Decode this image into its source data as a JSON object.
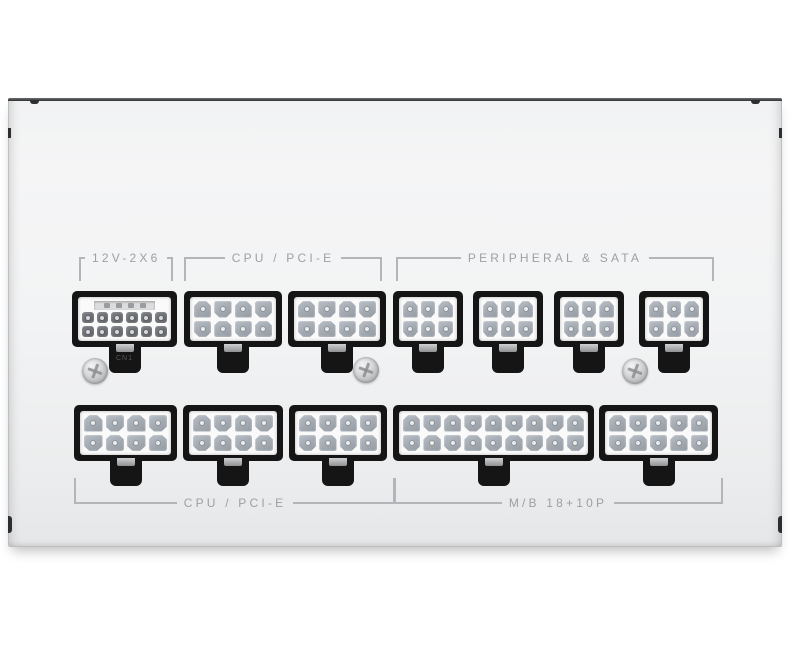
{
  "scene": {
    "type": "product-photo",
    "subject": "White fully modular power supply — modular cable connector panel, top-down view",
    "background_color": "#ffffff"
  },
  "labels": {
    "top": [
      {
        "text": "12V-2X6"
      },
      {
        "text": "CPU / PCI-E"
      },
      {
        "text": "PERIPHERAL & SATA"
      }
    ],
    "bottom": [
      {
        "text": "CPU / PCI-E"
      },
      {
        "text": "M/B 18+10P"
      }
    ]
  },
  "connectors": {
    "top_row": [
      {
        "name": "12v-2x6",
        "type": "12+4-pin 12V-2X6",
        "cols": 6,
        "rows": 2,
        "sense_pins": 4,
        "pin_style": "dark",
        "tab_label": "CN1"
      },
      {
        "name": "cpu-pcie-top-1",
        "type": "8-pin",
        "cols": 4,
        "rows": 2,
        "sense_pins": 0,
        "pin_style": "light",
        "tab_label": ""
      },
      {
        "name": "cpu-pcie-top-2",
        "type": "8-pin",
        "cols": 4,
        "rows": 2,
        "sense_pins": 0,
        "pin_style": "light",
        "tab_label": ""
      },
      {
        "name": "peripheral-sata-1",
        "type": "6-pin",
        "cols": 3,
        "rows": 2,
        "sense_pins": 0,
        "pin_style": "light",
        "tab_label": ""
      },
      {
        "name": "peripheral-sata-2",
        "type": "6-pin",
        "cols": 3,
        "rows": 2,
        "sense_pins": 0,
        "pin_style": "light",
        "tab_label": ""
      },
      {
        "name": "peripheral-sata-3",
        "type": "6-pin",
        "cols": 3,
        "rows": 2,
        "sense_pins": 0,
        "pin_style": "light",
        "tab_label": ""
      },
      {
        "name": "peripheral-sata-4",
        "type": "6-pin",
        "cols": 3,
        "rows": 2,
        "sense_pins": 0,
        "pin_style": "light",
        "tab_label": ""
      }
    ],
    "bottom_row": [
      {
        "name": "cpu-pcie-bottom-1",
        "type": "8-pin",
        "cols": 4,
        "rows": 2,
        "sense_pins": 0,
        "pin_style": "light",
        "tab_label": ""
      },
      {
        "name": "cpu-pcie-bottom-2",
        "type": "8-pin",
        "cols": 4,
        "rows": 2,
        "sense_pins": 0,
        "pin_style": "light",
        "tab_label": ""
      },
      {
        "name": "cpu-pcie-bottom-3",
        "type": "8-pin",
        "cols": 4,
        "rows": 2,
        "sense_pins": 0,
        "pin_style": "light",
        "tab_label": ""
      },
      {
        "name": "mb-18pin",
        "type": "18-pin motherboard",
        "cols": 9,
        "rows": 2,
        "sense_pins": 0,
        "pin_style": "light",
        "tab_label": ""
      },
      {
        "name": "mb-10pin",
        "type": "10-pin motherboard",
        "cols": 5,
        "rows": 2,
        "sense_pins": 0,
        "pin_style": "light",
        "tab_label": ""
      }
    ]
  },
  "hardware": {
    "screw_count": 3
  },
  "colors": {
    "body": "#f0f1f2",
    "edge_dark": "#303234",
    "bezel": "#151516",
    "connwhite": "#fafafa",
    "pin_light": "#a9aeb5",
    "pin_dark": "#6d7074",
    "label": "#9da0a3",
    "line": "#b3b5b8"
  }
}
